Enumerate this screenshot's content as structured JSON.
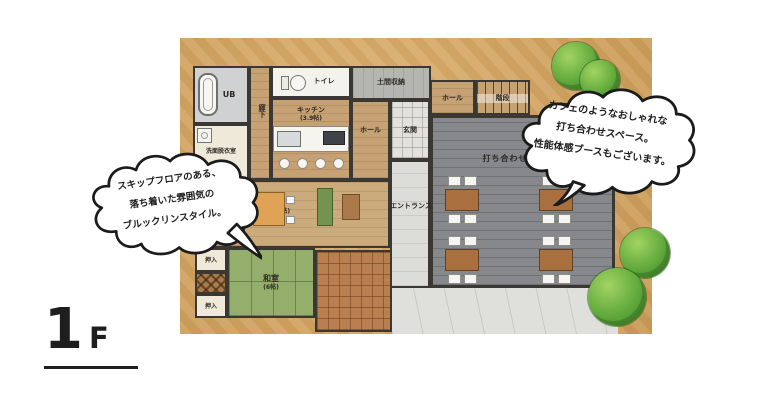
{
  "floor_label": {
    "number": "1",
    "suffix": "F"
  },
  "bubble_left": {
    "line1": "スキップフロアのある、",
    "line2": "落ち着いた雰囲気の",
    "line3": "ブルックリンスタイル。"
  },
  "bubble_right": {
    "line1": "カフェのようなおしゃれな",
    "line2": "打ち合わせスペース。",
    "line3": "性能体感ブースもございます。"
  },
  "rooms": {
    "ub": "UB",
    "senmen": "洗面脱衣室",
    "rouka": "廊下",
    "toilet": "トイレ",
    "kitchen": "キッチン",
    "kitchen_size": "(3.9帖)",
    "doma": "土間収納",
    "hall_left": "ホール",
    "genkan": "玄関",
    "hall_right": "ホール",
    "stairs": "階段",
    "meeting": "打ち合わせスペース",
    "entrance": "エントランス",
    "ld": "LD",
    "ld_size": "(12.5帖)",
    "nando": "階段下納戸",
    "oshiire_top": "押入",
    "oshiire_bottom": "押入",
    "washitsu": "和室",
    "washitsu_size": "(6帖)"
  },
  "colors": {
    "ground": "#d2a462",
    "wood": "#c5a173",
    "meeting_floor": "#86888b",
    "tatami": "#94ae6b",
    "terrace": "#ba7f50",
    "concrete": "#dfdfdb",
    "wall": "#3b3833",
    "tree_green": "#4f9632"
  }
}
